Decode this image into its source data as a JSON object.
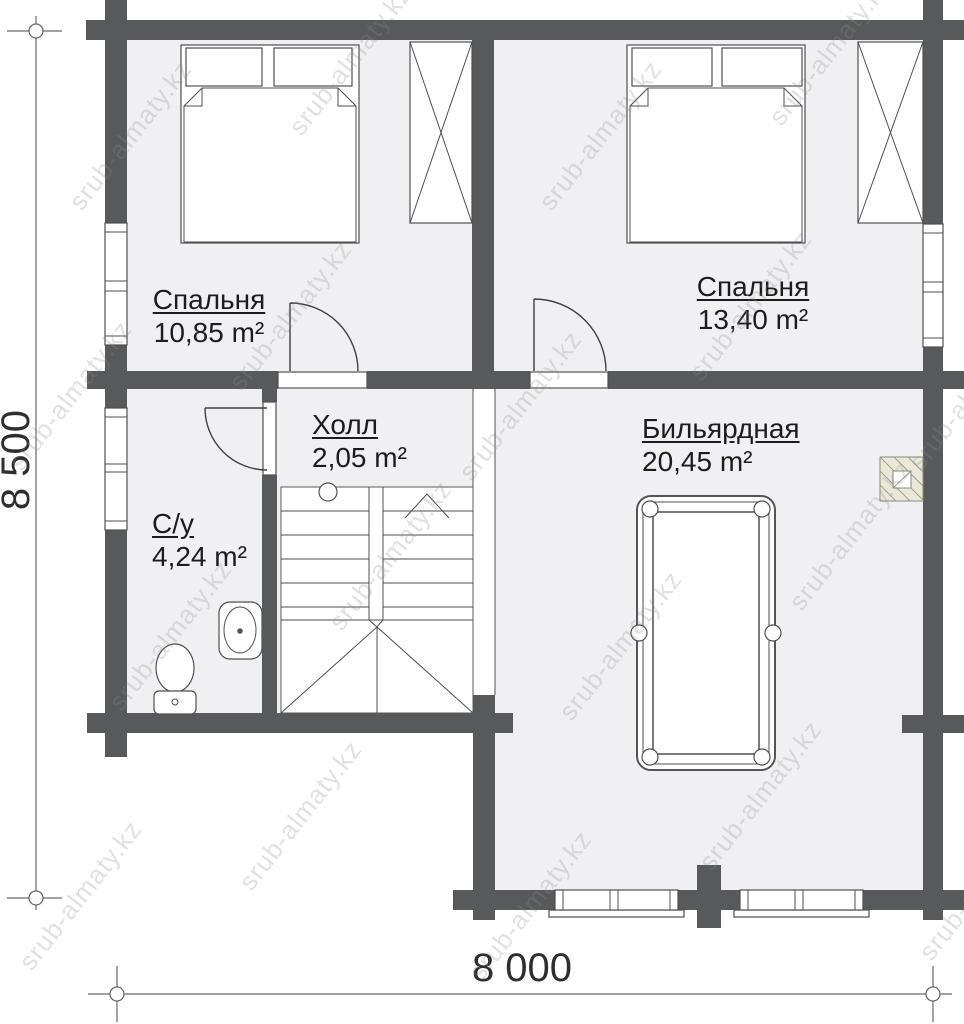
{
  "watermark": {
    "text": "srub-almaty.kz"
  },
  "rooms": {
    "bedroom1": {
      "name": "Спальня",
      "area": "10,85 m²"
    },
    "bedroom2": {
      "name": "Спальня",
      "area": "13,40 m²"
    },
    "hall": {
      "name": "Холл",
      "area": "2,05 m²"
    },
    "bathroom": {
      "name": "С/у",
      "area": "4,24 m²"
    },
    "billiard": {
      "name": "Бильярдная",
      "area": "20,45 m²"
    }
  },
  "dimensions": {
    "horizontal": "8 000",
    "vertical": "8 500"
  },
  "colors": {
    "wall": "#58595a",
    "floor": "#f0f0f2",
    "line": "#4f4f4f",
    "text": "#1c1c1c",
    "chimney": "#eae9d9"
  }
}
